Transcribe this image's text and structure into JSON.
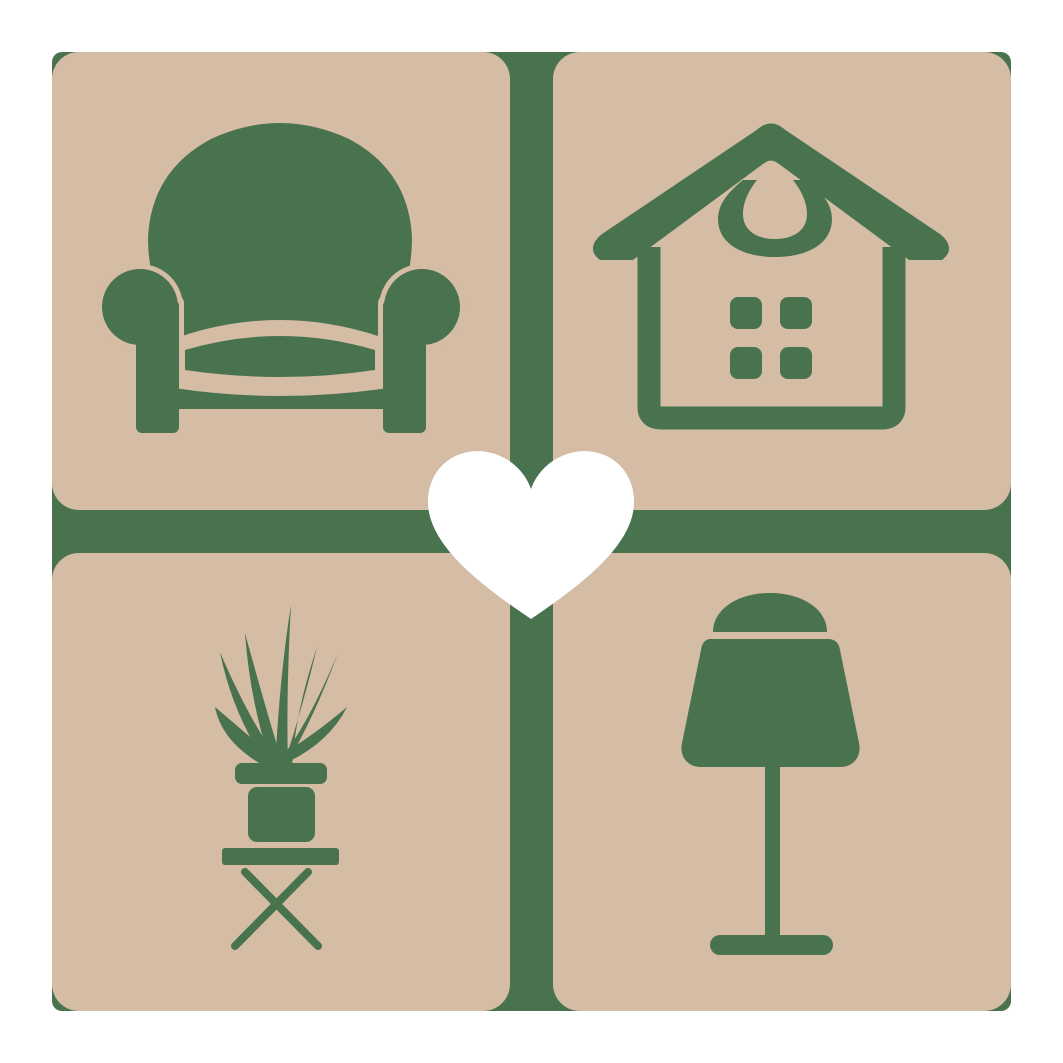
{
  "logo": {
    "colors": {
      "background": "#FFFFFF",
      "tile": "#D4BCA5",
      "icon": "#49734E",
      "divider": "#49734E",
      "heart": "#FFFFFF"
    },
    "tiles": [
      {
        "position": "top-left",
        "icon": "armchair-icon"
      },
      {
        "position": "top-right",
        "icon": "house-icon"
      },
      {
        "position": "bottom-left",
        "icon": "potted-plant-icon"
      },
      {
        "position": "bottom-right",
        "icon": "table-lamp-icon"
      }
    ],
    "center_icon": "heart-icon"
  }
}
